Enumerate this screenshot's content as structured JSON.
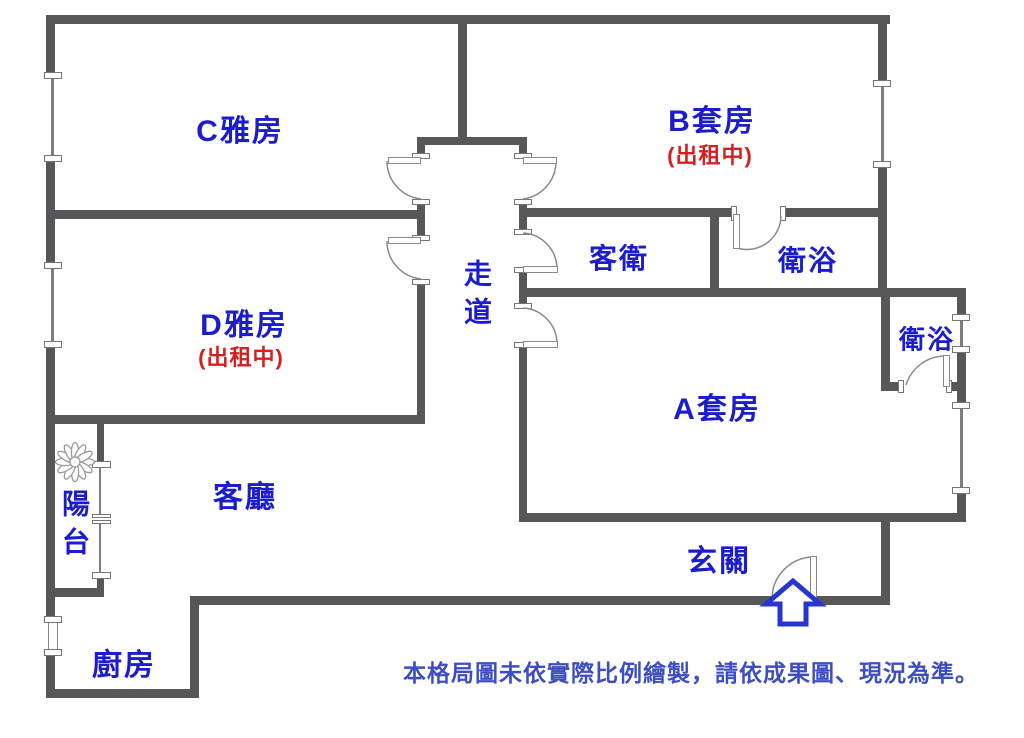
{
  "floorplan": {
    "rooms": {
      "room_c": {
        "label": "C雅房"
      },
      "room_b": {
        "label": "B套房",
        "status": "(出租中)"
      },
      "room_d": {
        "label": "D雅房",
        "status": "(出租中)"
      },
      "room_a": {
        "label": "A套房"
      },
      "corridor": {
        "label": "走道"
      },
      "guest_bath": {
        "label": "客衛"
      },
      "bath_b": {
        "label": "衛浴"
      },
      "bath_a": {
        "label": "衛浴"
      },
      "living": {
        "label": "客廳"
      },
      "balcony": {
        "label": "陽台"
      },
      "entry": {
        "label": "玄關"
      },
      "kitchen": {
        "label": "廚房"
      }
    },
    "disclaimer": "本格局圖未依實際比例繪製，請依成果圖、現況為準。",
    "colors": {
      "wall": "#57575a",
      "room_label": "#1b1ccd",
      "status_label": "#d32020",
      "disclaimer_text": "#3d4dc3",
      "entrance_arrow": "#2636cf"
    }
  }
}
